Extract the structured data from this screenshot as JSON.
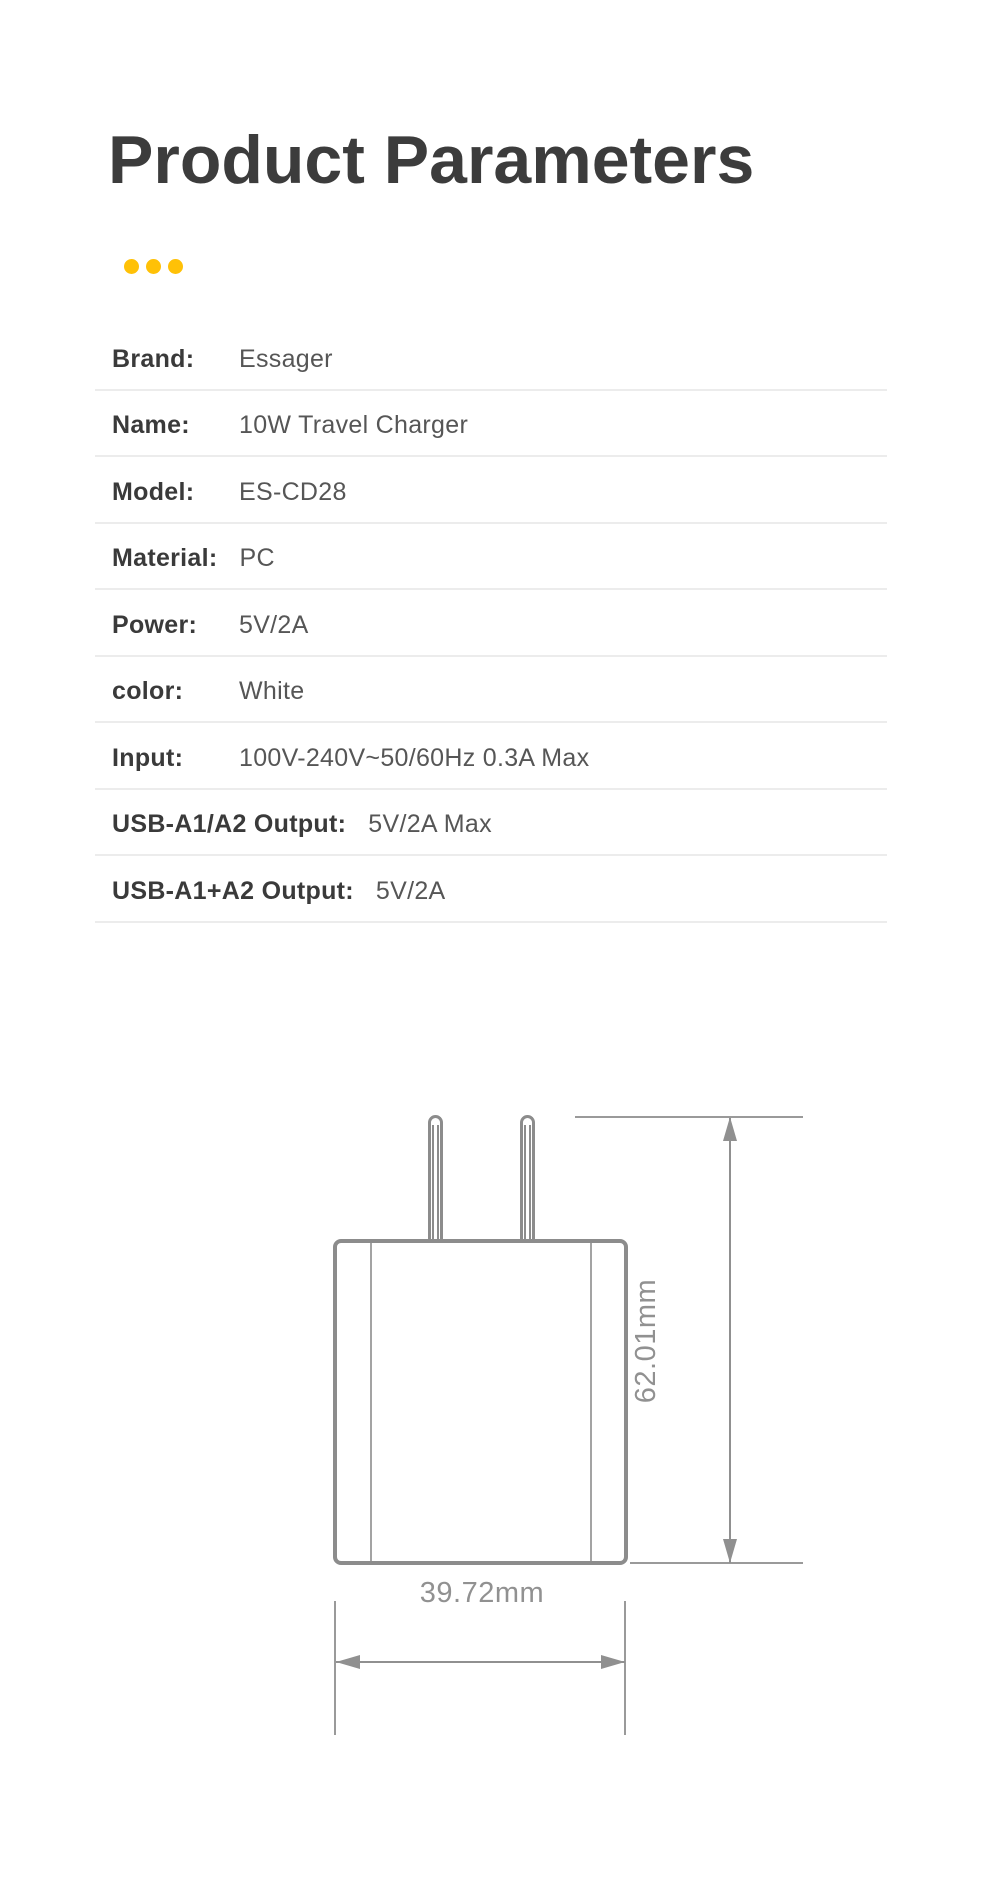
{
  "page": {
    "title": "Product Parameters",
    "title_color": "#3c3c3c",
    "background": "#ffffff"
  },
  "decor": {
    "dot_count": 3,
    "dot_color": "#FFC107"
  },
  "spec_table": {
    "divider_color": "#ececec",
    "label_color": "#3a3a3a",
    "value_color": "#565656",
    "rows": [
      {
        "label": "Brand:",
        "value": "Essager"
      },
      {
        "label": "Name:",
        "value": "10W Travel Charger"
      },
      {
        "label": "Model:",
        "value": "ES-CD28"
      },
      {
        "label": "Material:",
        "value": "PC"
      },
      {
        "label": "Power:",
        "value": "5V/2A"
      },
      {
        "label": "color:",
        "value": "White"
      },
      {
        "label": "Input:",
        "value": "100V-240V~50/60Hz 0.3A Max"
      },
      {
        "label": "USB-A1/A2 Output:",
        "value": "5V/2A Max"
      },
      {
        "label": "USB-A1+A2 Output:",
        "value": "5V/2A"
      }
    ]
  },
  "diagram": {
    "height_label": "62.01mm",
    "width_label": "39.72mm",
    "line_color": "#8c8c8c",
    "label_color": "#919191"
  }
}
